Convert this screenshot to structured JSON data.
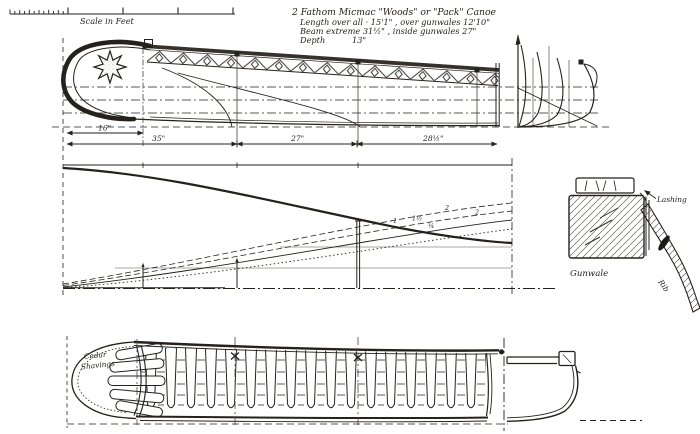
{
  "palette": {
    "paper": "#ffffff",
    "ink": "#25221d",
    "ink_light": "#55504a"
  },
  "scale_bar": {
    "label": "Scale in Feet"
  },
  "title_block": {
    "line1": "2 Fathom Micmac \"Woods\" or \"Pack\" Canoe",
    "line2": "Length over all · 15'1\" , over gunwales 12'10\"",
    "line3": "Beam extreme   31½\" , inside gunwales 27\"",
    "line4_label": "Depth",
    "line4_value": "13\""
  },
  "dimensions": {
    "bow_offset": "16\"",
    "segment1": "35\"",
    "segment2": "27\"",
    "segment3": "28½\""
  },
  "waterline_labels": {
    "a": "2",
    "b": "2",
    "c": "1",
    "d": "1½",
    "e": "¼"
  },
  "plan_view": {
    "cedar_line1": "Cedar",
    "cedar_line2": "Shavings"
  },
  "gunwale_detail": {
    "lashing": "Lashing",
    "gunwale": "Gunwale",
    "rib": "Rib"
  }
}
